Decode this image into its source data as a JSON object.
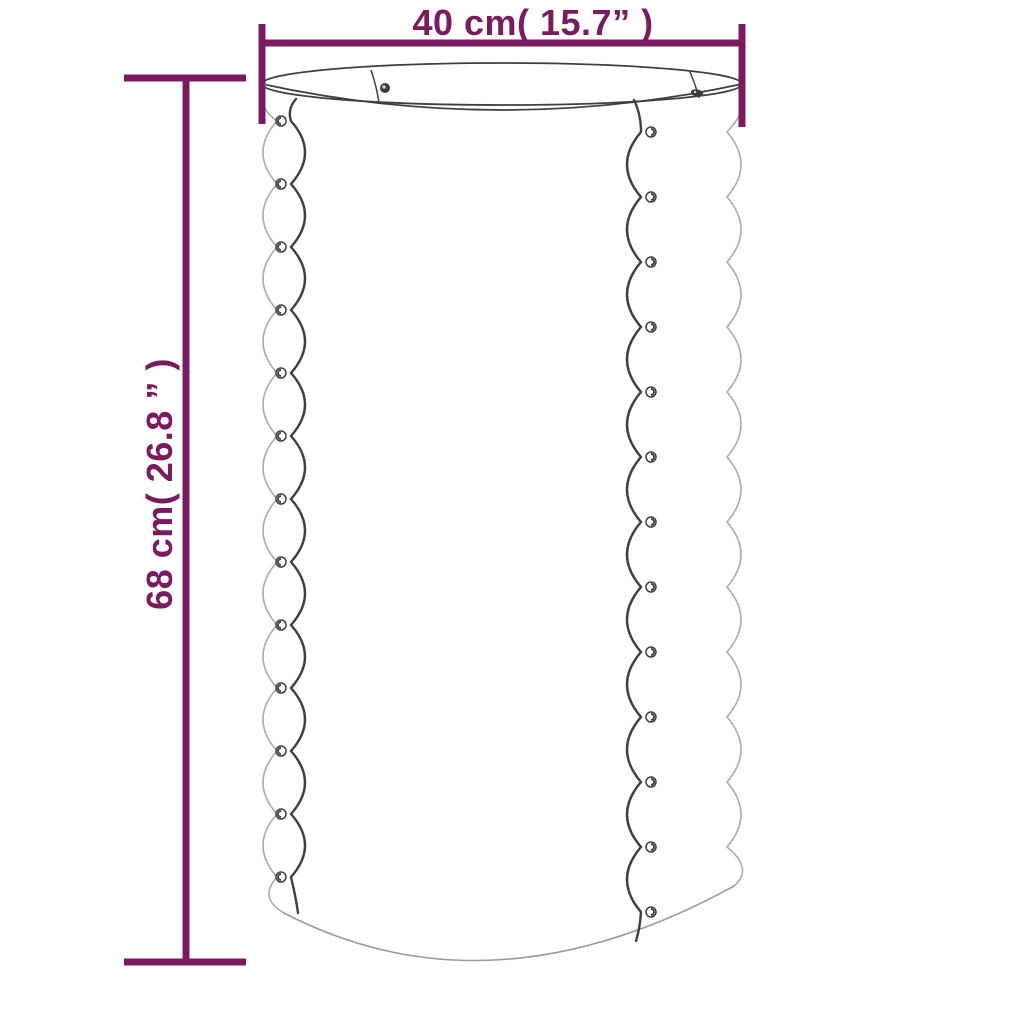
{
  "page": {
    "background": "#ffffff"
  },
  "colors": {
    "dimension": "#7b1a5c",
    "line_dark": "#3f3f3f",
    "line_mid": "#9b9b9b",
    "line_light": "#ababab"
  },
  "dimensions": {
    "width": {
      "label": "40 cm( 15.7” )"
    },
    "height": {
      "label": "68 cm( 26.8 ” )"
    }
  },
  "figure": {
    "type": "product-line-drawing",
    "subject": "corrugated-cylinder-planter",
    "rim_rivet_count": 2,
    "left_seam_rivet_count": 13,
    "right_seam_rivet_count": 13,
    "left_rivets": {
      "cx": 281,
      "y_start": 121,
      "y_step": 63
    },
    "right_rivets": {
      "cx": 651,
      "y_start": 132,
      "y_step": 65
    }
  }
}
